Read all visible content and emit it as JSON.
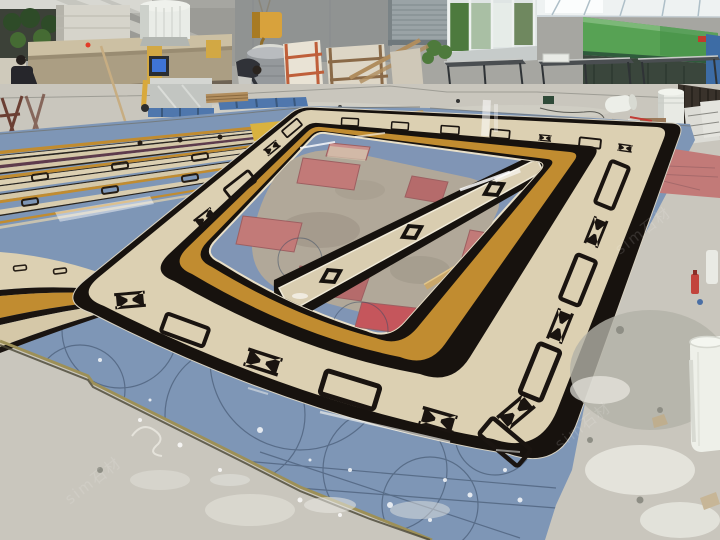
{
  "scene": {
    "type": "photograph",
    "setting": "stone fabrication workshop interior, wide angle from floor level",
    "subject": "large marble waterjet medallion border panels dry-laid on the factory floor for assembly",
    "watermark": {
      "text": "sim石材",
      "color": "#ffffff",
      "opacity": 0.13
    }
  },
  "palette": {
    "panel_blue": "#7e96b6",
    "panel_blue_light": "#8fa6c2",
    "marble_cream": "#dcd0b2",
    "marble_gold": "#c18c30",
    "marble_black": "#17120e",
    "panel_pink": "#c27a78",
    "accent_red": "#c5565c",
    "maroon_strip": "#5e3c4c",
    "concrete": "#c9c6bd",
    "machine_green": "#57a254",
    "bucket_white": "#eef0e9",
    "wall_gray": "#a6a6a1",
    "ceiling_white": "#eef2f2",
    "pallet_blue": "#4f77ad",
    "hoist_yellow": "#d8a23c",
    "scribe_line": "#3a4c64"
  },
  "objects": [
    {
      "name": "medallion-border-ring",
      "label": "polished marble border with gold band and black bowtie motifs"
    },
    {
      "name": "blue-backing-panels",
      "label": "blue backing boards with pencil scribe arcs"
    },
    {
      "name": "striped-border-panels",
      "label": "parallel long border strips awaiting assembly"
    },
    {
      "name": "pink-infill-panels",
      "label": "rough pink stone infill pieces"
    },
    {
      "name": "center-strip",
      "label": "polished black/cream strip with diamond motifs"
    },
    {
      "name": "wood-battens",
      "label": "wooden battens lying on panels"
    },
    {
      "name": "white-bucket",
      "label": "white plastic bucket at right edge"
    },
    {
      "name": "roller-shutter-door",
      "label": "grey roller shutter door"
    },
    {
      "name": "window-bay",
      "label": "windows with green foliage outside"
    },
    {
      "name": "green-machine",
      "label": "green machine panel"
    },
    {
      "name": "work-tables",
      "label": "steel work tables"
    },
    {
      "name": "bridge-saw",
      "label": "beige stone cutting machine with monitor"
    },
    {
      "name": "water-tank",
      "label": "white cylindrical tank"
    },
    {
      "name": "crane-hoist",
      "label": "yellow crane hook block and drum"
    },
    {
      "name": "workers",
      "label": "two workers"
    },
    {
      "name": "slab-racks",
      "label": "stone slabs on A-frame racks"
    },
    {
      "name": "pallets",
      "label": "blue pallets and wrapped stack"
    },
    {
      "name": "debris",
      "label": "plaster patches, splatters, tools and debris on concrete"
    }
  ]
}
